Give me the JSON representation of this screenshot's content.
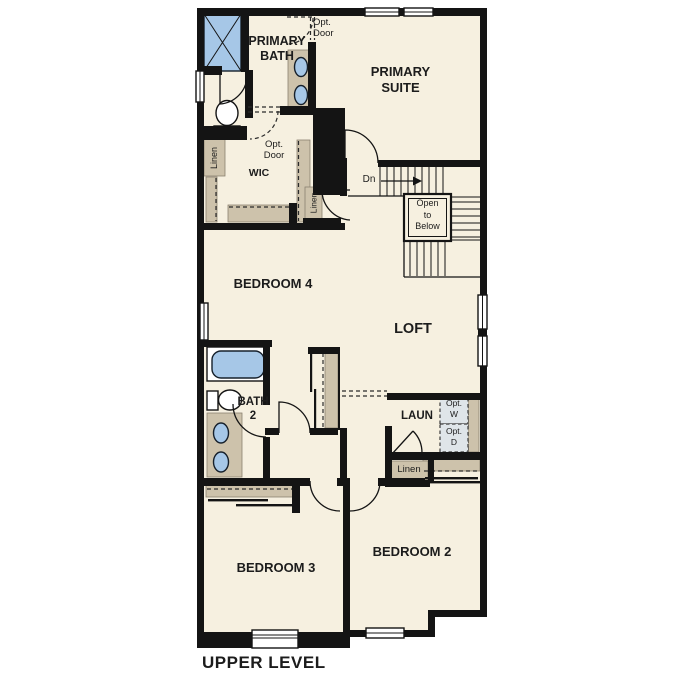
{
  "page_title": "UPPER LEVEL",
  "colors": {
    "floor": "#f6f0e0",
    "wall": "#141414",
    "cabinet": "#cdc2ab",
    "fixture_blue": "#a6c7e7",
    "appliance": "#dfe5e9"
  },
  "rooms": {
    "primary_bath": "PRIMARY\nBATH",
    "primary_suite": "PRIMARY\nSUITE",
    "wic": "WIC",
    "bedroom_4": "BEDROOM 4",
    "loft": "LOFT",
    "bath_2": "BATH\n2",
    "laundry": "LAUN",
    "bedroom_3": "BEDROOM 3",
    "bedroom_2": "BEDROOM 2"
  },
  "annotations": {
    "opt_door_upper": "Opt.\nDoor",
    "opt_door_wic": "Opt.\nDoor",
    "linen_wic": "Linen",
    "linen_hall": "Linen",
    "linen_laundry": "Linen",
    "stairs_down": "Dn",
    "open_to_below": "Open\nto\nBelow",
    "opt_washer": "Opt.\nW",
    "opt_dryer": "Opt.\nD"
  }
}
